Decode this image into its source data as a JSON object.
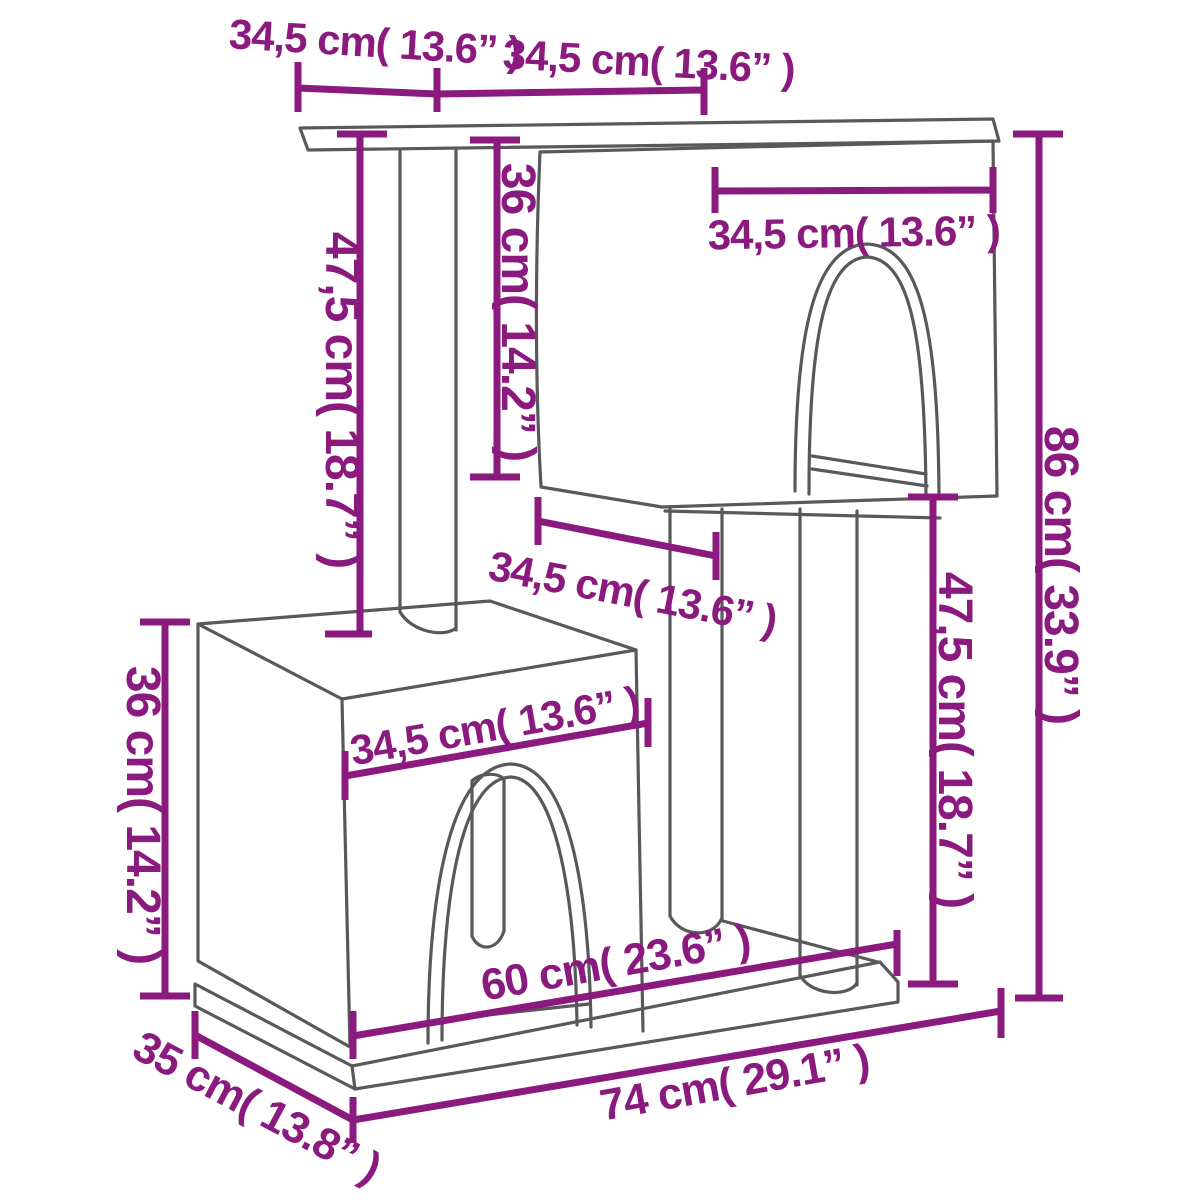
{
  "title": "Cat tree with condos and scratching posts - dimension diagram",
  "colors": {
    "dimension_accent": "#8B1A7E",
    "drawing_outline": "#59595B",
    "background": "#FFFFFF"
  },
  "units": "cm (inches)",
  "dimensions": {
    "top_width_left": {
      "label": "34,5 cm( 13.6” )",
      "cm": "34,5",
      "inch": "13.6"
    },
    "top_width_right": {
      "label": "34,5 cm( 13.6” )",
      "cm": "34,5",
      "inch": "13.6"
    },
    "upper_post_height": {
      "label": "47,5 cm( 18.7” )",
      "cm": "47,5",
      "inch": "18.7"
    },
    "upper_condo_height": {
      "label": "36 cm( 14.2” )",
      "cm": "36",
      "inch": "14.2"
    },
    "upper_condo_width": {
      "label": "34,5 cm( 13.6” )",
      "cm": "34,5",
      "inch": "13.6"
    },
    "total_height": {
      "label": "86 cm( 33.9” )",
      "cm": "86",
      "inch": "33.9"
    },
    "middle_width": {
      "label": "34,5 cm( 13.6” )",
      "cm": "34,5",
      "inch": "13.6"
    },
    "lower_post_height": {
      "label": "47,5 cm( 18.7” )",
      "cm": "47,5",
      "inch": "18.7"
    },
    "lower_condo_height": {
      "label": "36 cm( 14.2” )",
      "cm": "36",
      "inch": "14.2"
    },
    "lower_condo_width": {
      "label": "34,5 cm( 13.6” )",
      "cm": "34,5",
      "inch": "13.6"
    },
    "base_inner_width": {
      "label": "60 cm( 23.6” )",
      "cm": "60",
      "inch": "23.6"
    },
    "base_width": {
      "label": "74 cm( 29.1” )",
      "cm": "74",
      "inch": "29.1"
    },
    "base_depth": {
      "label": "35 cm( 13.8” )",
      "cm": "35",
      "inch": "13.8"
    }
  }
}
